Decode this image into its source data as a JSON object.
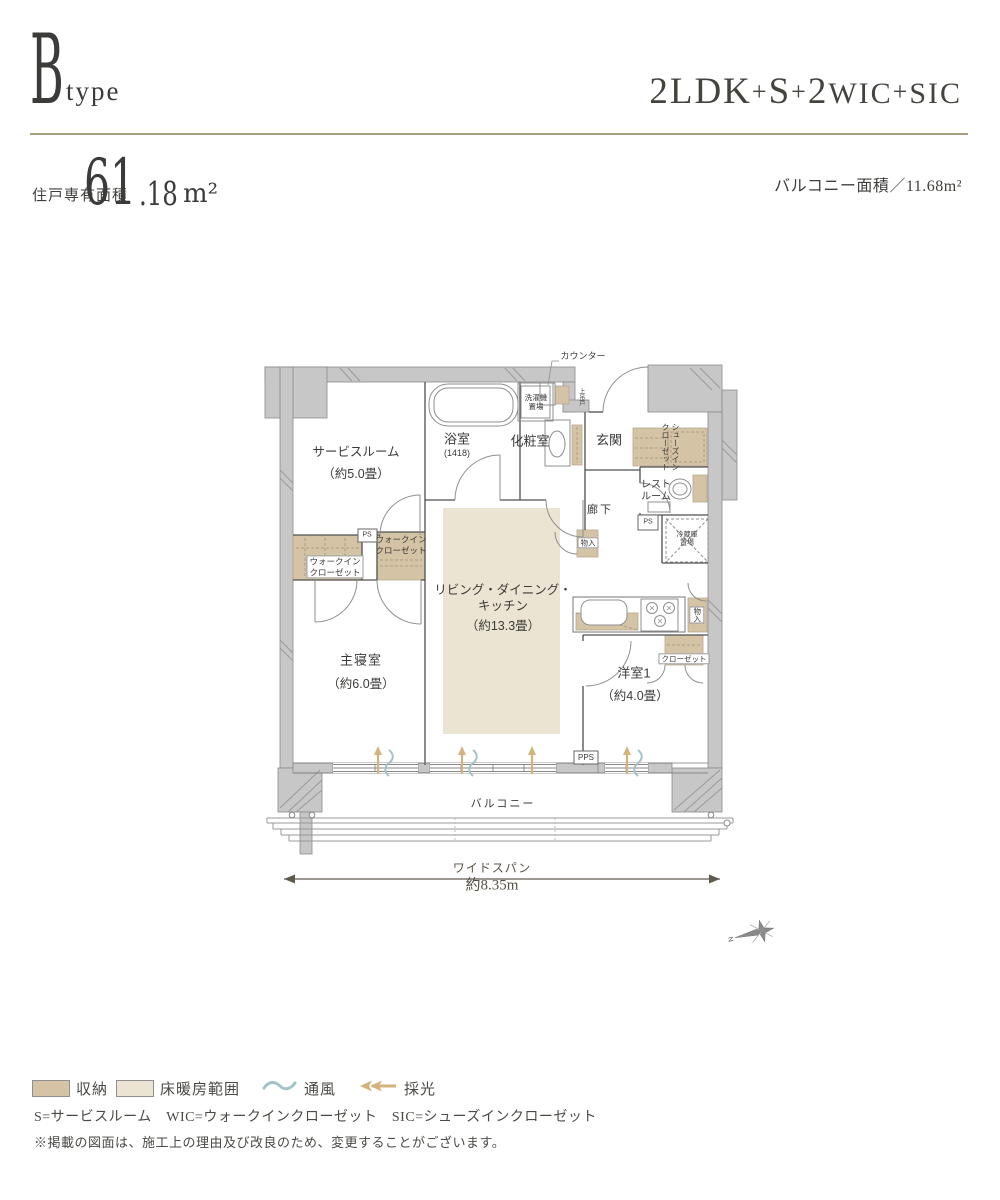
{
  "header": {
    "type_letter": "B",
    "type_word": "type",
    "layout_segments": [
      "2LDK",
      "+",
      "S",
      "+",
      "2",
      "WIC",
      "+",
      "SIC"
    ],
    "area_label": "住戸専有面積",
    "area_int": "61",
    "area_dec": ".18",
    "area_unit": "m²",
    "balcony_area": "バルコニー面積／11.68m²"
  },
  "plan": {
    "labels": {
      "counter": "カウンター",
      "laundry": "洗濯機\n置場",
      "bath_name": "浴室",
      "bath_size": "(1418)",
      "powder": "化粧室",
      "genkan": "玄関",
      "door_note": "上吊戸",
      "sic": "シューズイン\nクローゼット",
      "restroom": "レスト\nルーム",
      "hallway": "廊下",
      "ps1": "PS",
      "ps2": "PS",
      "pps": "PPS",
      "storage_hall": "物入",
      "storage_kitchen": "物入",
      "fridge": "冷蔵庫\n置場",
      "wic_left": "ウォークイン\nクローゼット",
      "wic_right": "ウォークイン\nクローゼット",
      "service_name": "サービスルーム",
      "service_size": "（約5.0畳）",
      "ldk_name": "リビング・ダイニング・\nキッチン",
      "ldk_size": "（約13.3畳）",
      "bedroom_name": "主寝室",
      "bedroom_size": "（約6.0畳）",
      "western_name": "洋室1",
      "western_size": "（約4.0畳）",
      "closet": "クローゼット",
      "balcony": "バルコニー"
    },
    "dimension": {
      "label": "ワイドスパン",
      "value": "約8.35m"
    },
    "compass": "N"
  },
  "legend": {
    "storage_label": "収納",
    "heating_label": "床暖房範囲",
    "vent_label": "通風",
    "light_label": "採光",
    "abbr": "S=サービスルーム　WIC=ウォークインクローゼット　SIC=シューズインクローゼット",
    "note": "※掲載の図面は、施工上の理由及び改良のため、変更することがございます。"
  },
  "colors": {
    "storage_tan": "#d5c3a6",
    "floor_heating_cream": "#ece4d2",
    "vent_teal": "#a3c3c9",
    "light_gold": "#d4b27c",
    "wall_gray": "#c7c7c7",
    "rule_gold": "#a89e80"
  }
}
